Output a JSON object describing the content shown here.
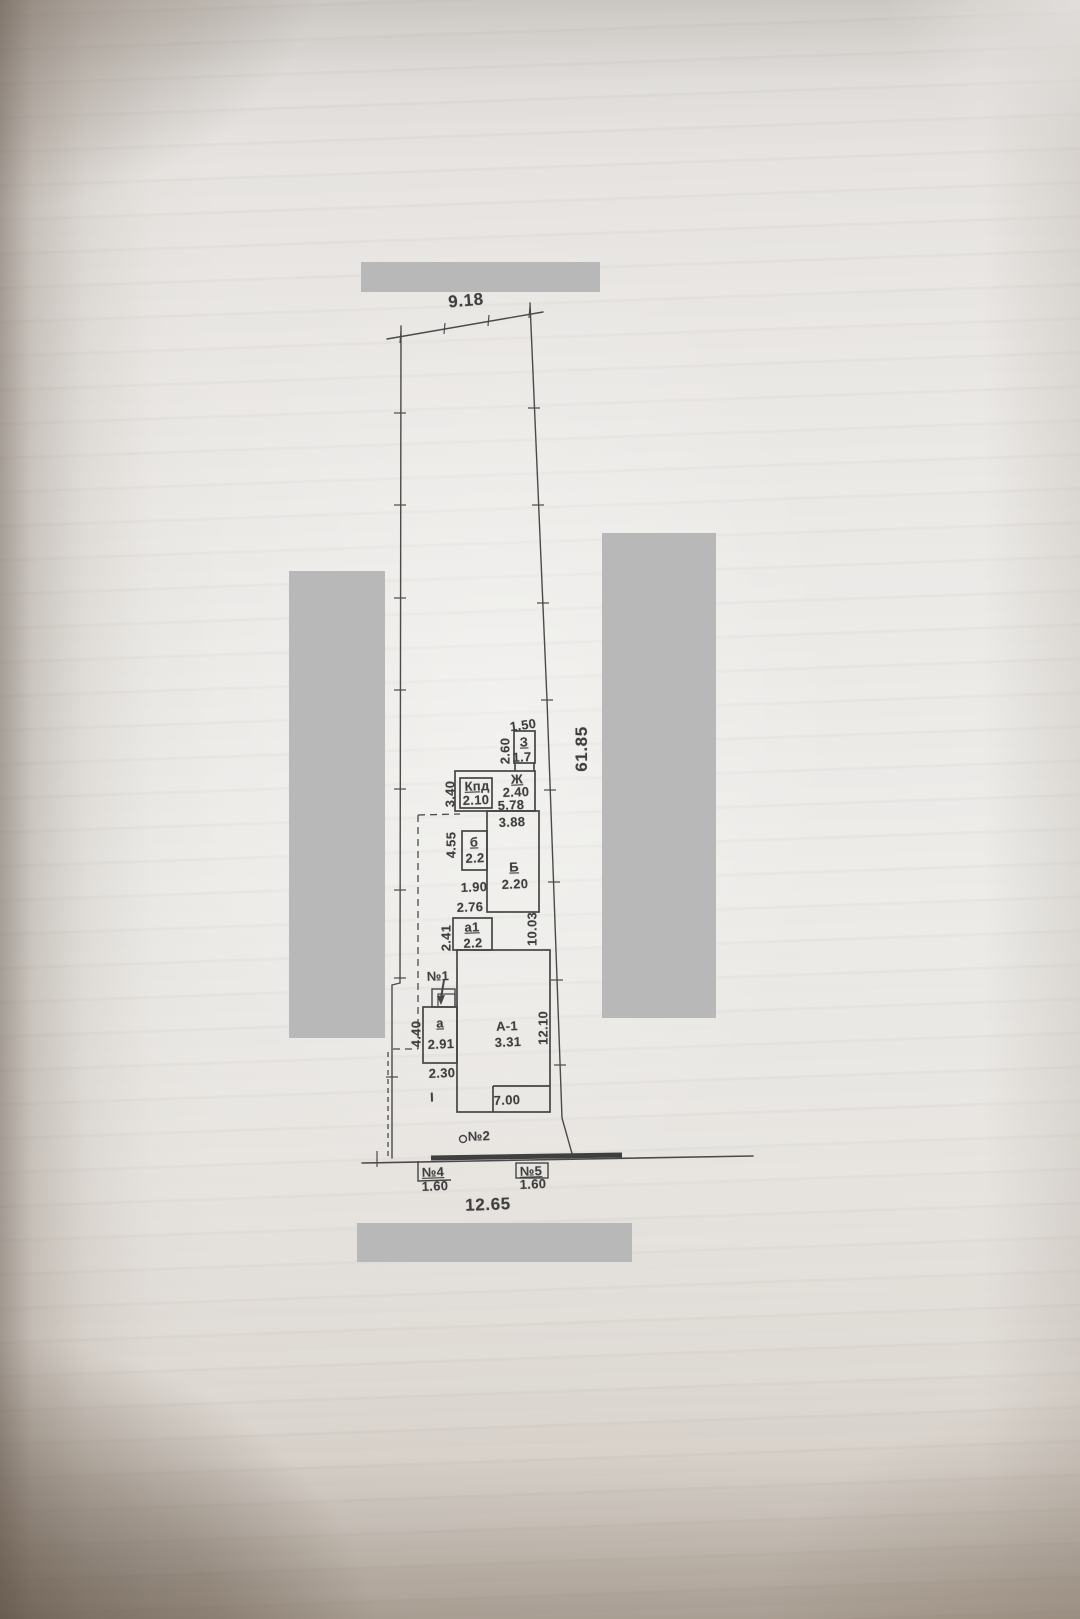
{
  "photo": {
    "redaction_color": "#b8b8b8"
  },
  "plan": {
    "parcel_dimensions": {
      "top_width": "9.18",
      "right_length": "61.85",
      "bottom_width": "12.65"
    },
    "rooms": {
      "z": {
        "label": "З",
        "value": "1.7"
      },
      "zh": {
        "label": "Ж",
        "value": "2.40"
      },
      "kpd": {
        "label": "Кпд",
        "value": "2.10"
      },
      "b_small": {
        "label": "б",
        "value": "2.2"
      },
      "b": {
        "label": "Б",
        "value": "2.20"
      },
      "a1": {
        "label": "а1",
        "value": "2.2"
      },
      "house": {
        "label": "А-1",
        "value": "3.31"
      },
      "a": {
        "label": "а",
        "value": "2.91"
      }
    },
    "dimensions": {
      "z_top": "1.50",
      "z_left": "2.60",
      "kpd_left": "3.40",
      "zh_bottom": "5.78",
      "b_top": "3.88",
      "b_small_left": "4.55",
      "b_small_bottom": "1.90",
      "a1_top": "2.76",
      "a1_left": "2.41",
      "b_right": "10.03",
      "house_right": "12.10",
      "house_bottom": "7.00",
      "a_left": "4.40",
      "a_bottom": "2.30"
    },
    "markers": {
      "n1": {
        "label": "№1"
      },
      "n2": {
        "label": "№2"
      },
      "n4": {
        "label": "№4",
        "value": "1.60"
      },
      "n5": {
        "label": "№5",
        "value": "1.60"
      },
      "roman_i": {
        "label": "I"
      }
    }
  }
}
